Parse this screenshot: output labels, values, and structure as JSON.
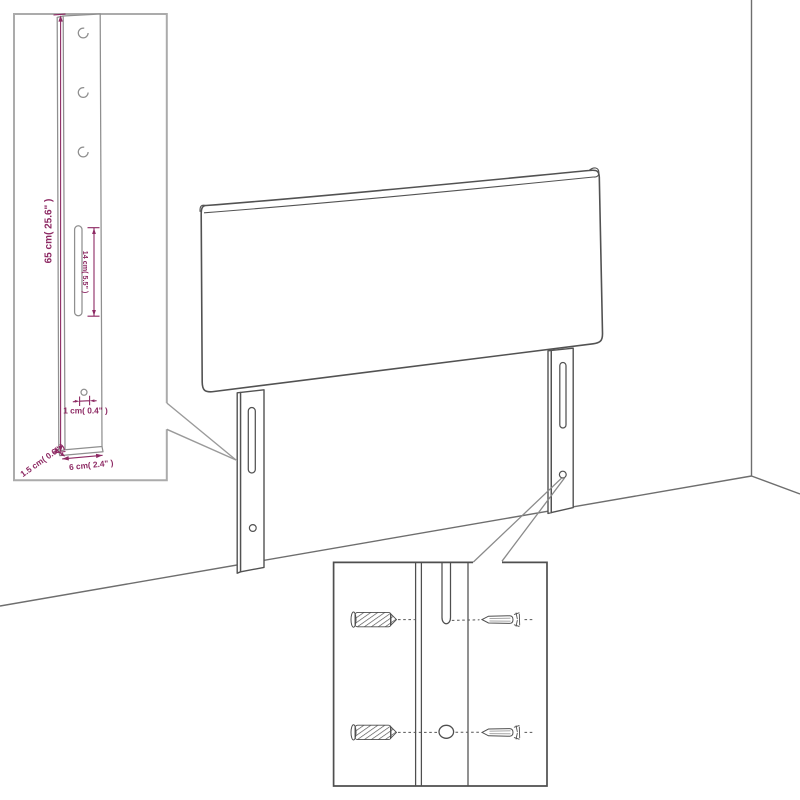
{
  "diagram": {
    "type": "furniture-dimension-diagram",
    "subject": "headboard-with-two-mounting-legs",
    "colors": {
      "background": "#ffffff",
      "outline": "#4f4f4f",
      "outline_light": "#8f8f8f",
      "dimension": "#8d2963",
      "inset_border_light": "#ababab"
    },
    "leg_inset": {
      "labels": {
        "leg_height": "65 cm( 25.6\" )",
        "slot_length": "14 cm( 5.5\" )",
        "hole_diameter": "1 cm( 0.4\" )",
        "leg_thickness": "1.5 cm( 0.6\" )",
        "leg_width": "6 cm( 2.4\" )"
      }
    }
  }
}
